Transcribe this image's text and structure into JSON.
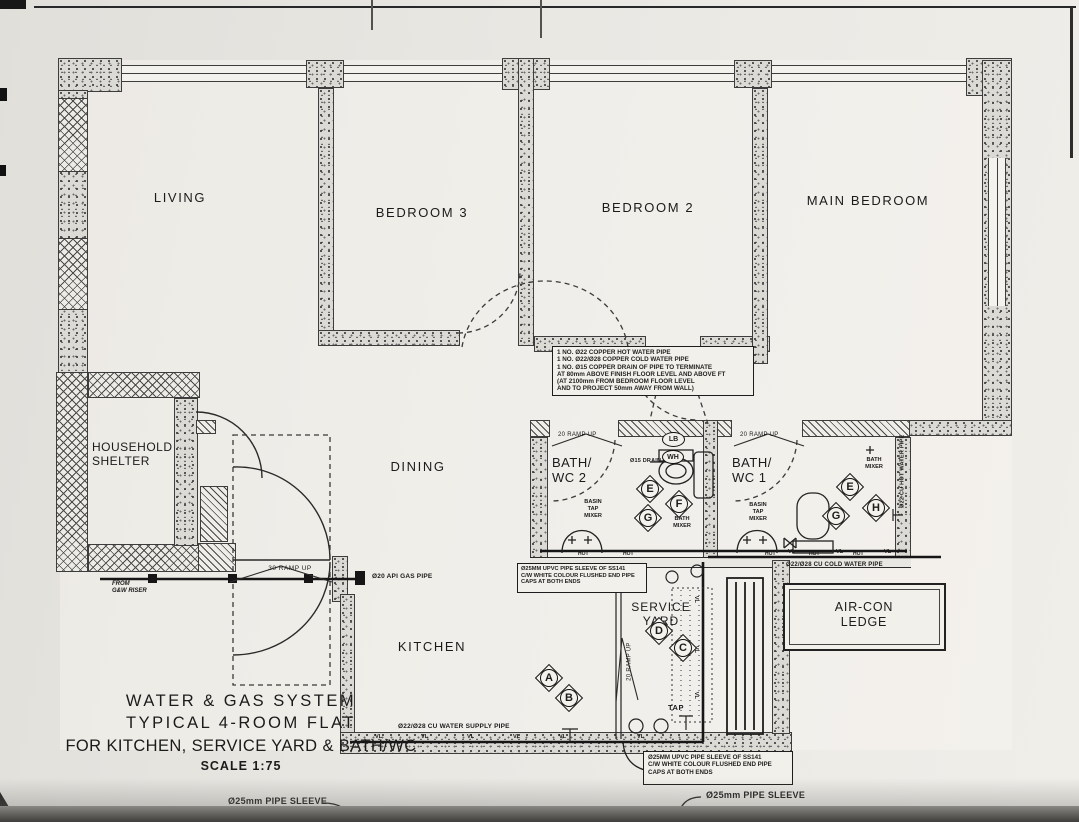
{
  "drawing": {
    "rooms": {
      "living": "LIVING",
      "bedroom3": "BEDROOM 3",
      "bedroom2": "BEDROOM 2",
      "main_bedroom": "MAIN BEDROOM",
      "household_shelter": "HOUSEHOLD\nSHELTER",
      "dining": "DINING",
      "bath_wc_2": "BATH/\nWC 2",
      "bath_wc_1": "BATH/\nWC 1",
      "kitchen": "KITCHEN",
      "service_yard": "SERVICE\nYARD",
      "aircon_ledge": "AIR-CON\nLEDGE"
    },
    "title_block": {
      "line1": "WATER & GAS SYSTEM",
      "line2": "TYPICAL 4-ROOM FLAT",
      "line3": "FOR KITCHEN, SERVICE YARD & BATH/WC",
      "line4": "SCALE 1:75"
    },
    "notes": {
      "copper_pipe": [
        "1 NO. Ø22 COPPER HOT WATER PIPE",
        "1 NO. Ø22/Ø28 COPPER COLD WATER PIPE",
        "1 NO. Ø15 COPPER DRAIN OF PIPE TO TERMINATE",
        "AT 80mm ABOVE FINISH FLOOR LEVEL AND ABOVE FT",
        "(AT 2100mm FROM BEDROOM FLOOR LEVEL",
        "AND TO PROJECT 50mm AWAY FROM WALL)"
      ],
      "upvc_sleeve": [
        "Ø25MM UPVC PIPE SLEEVE OF SS141",
        "C/W WHITE COLOUR FLUSHED END PIPE",
        "CAPS AT BOTH ENDS"
      ]
    },
    "pipe_labels": {
      "gas": "Ø20 API GAS PIPE",
      "water_supply": "Ø22/Ø28 CU WATER SUPPLY PIPE",
      "cold_water": "Ø22/Ø28 CU COLD WATER PIPE",
      "hot_water_vertical": "Ø22 CU HOT WATER PIPE",
      "pipe_sleeve": "Ø25mm PIPE SLEEVE",
      "riser": "FROM\nG&W RISER",
      "drain_off": "Ø15 DRAIN OFF"
    },
    "ramps": {
      "ramp30": "30 RAMP UP",
      "ramp20": "20 RAMP UP"
    },
    "fixtures": {
      "basin_tap_mixer": "BASIN\nTAP\nMIXER",
      "bath_mixer": "BATH\nMIXER",
      "tap": "TAP",
      "lb": "LB",
      "wh": "WH"
    },
    "symbols": {
      "vl": "VL",
      "hot": "HOT"
    },
    "markers": {
      "a": "A",
      "b": "B",
      "c": "C",
      "d": "D",
      "e": "E",
      "f": "F",
      "g": "G",
      "h": "H"
    }
  }
}
